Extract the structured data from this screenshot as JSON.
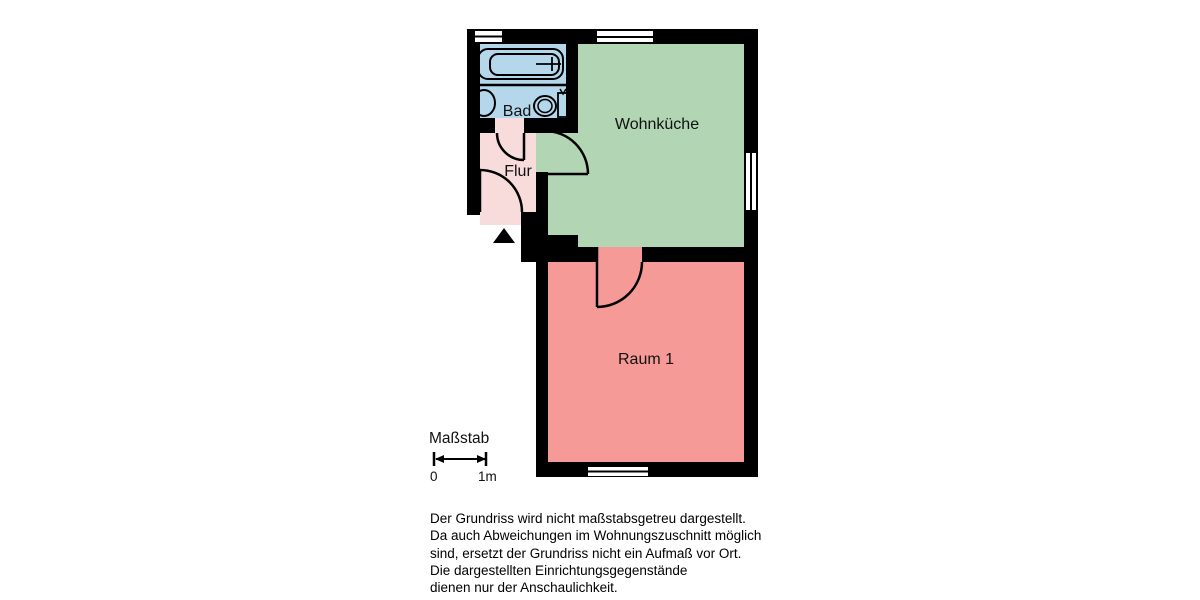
{
  "floorplan": {
    "wall_color": "#000000",
    "rooms": {
      "bad": {
        "label": "Bad",
        "color": "#b4d7eb"
      },
      "flur": {
        "label": "Flur",
        "color": "#f8dcdc"
      },
      "wohnkueche": {
        "label": "Wohnküche",
        "color": "#b2d5b4"
      },
      "raum1": {
        "label": "Raum 1",
        "color": "#f59a97"
      }
    }
  },
  "scale": {
    "title": "Maßstab",
    "min_label": "0",
    "max_label": "1m"
  },
  "disclaimer": {
    "lines": [
      "Der Grundriss wird nicht maßstabsgetreu dargestellt.",
      "Da auch Abweichungen im Wohnungszuschnitt möglich",
      "sind, ersetzt der Grundriss nicht ein Aufmaß vor Ort.",
      "Die dargestellten Einrichtungsgegenstände",
      "dienen nur der Anschaulichkeit."
    ]
  }
}
